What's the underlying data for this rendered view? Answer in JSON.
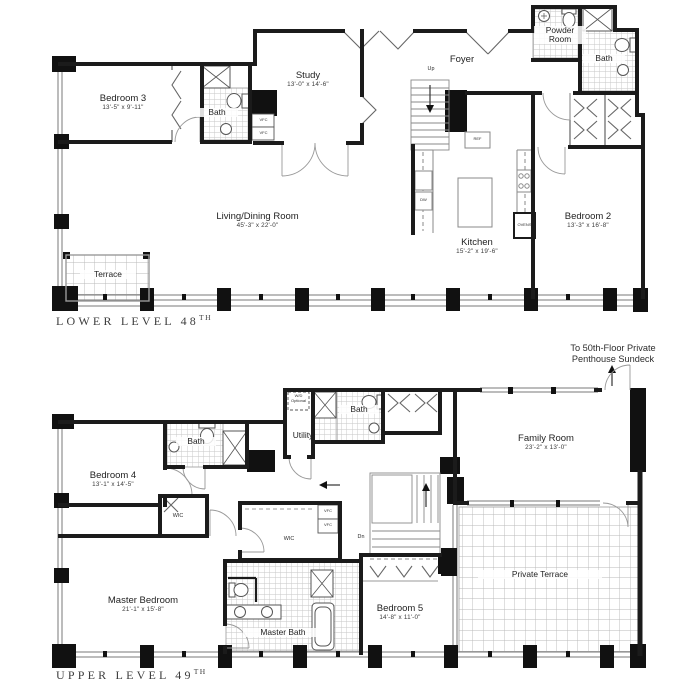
{
  "lower_level": {
    "title": "LOWER LEVEL 48",
    "title_ordinal": "TH",
    "rooms": {
      "bedroom_3": {
        "name": "Bedroom 3",
        "dims": "13'-5\" x 9'-11\""
      },
      "bath": {
        "name": "Bath"
      },
      "study": {
        "name": "Study",
        "dims": "13'-0\" x 14'-6\""
      },
      "foyer": {
        "name": "Foyer"
      },
      "powder_room": {
        "name": "Powder Room"
      },
      "bath_2": {
        "name": "Bath"
      },
      "bedroom_2": {
        "name": "Bedroom 2",
        "dims": "13'-3\" x 16'-8\""
      },
      "living_dining_room": {
        "name": "Living/Dining Room",
        "dims": "45'-3\" x 22'-0\""
      },
      "kitchen": {
        "name": "Kitchen",
        "dims": "15'-2\" x 19'-6\""
      },
      "terrace": {
        "name": "Terrace"
      }
    },
    "annotations": {
      "stair_up": "Up",
      "refrigerator": "REF",
      "dishwasher": "DW",
      "ovens": "OVENS",
      "vfc": "VFC"
    }
  },
  "upper_level": {
    "title": "UPPER LEVEL 49",
    "title_ordinal": "TH",
    "sundeck_note": {
      "line_1": "To 50th-Floor Private",
      "line_2": "Penthouse Sundeck"
    },
    "rooms": {
      "bedroom_4": {
        "name": "Bedroom 4",
        "dims": "13'-1\" x 14'-5\""
      },
      "bath": {
        "name": "Bath"
      },
      "utility": {
        "name": "Utility"
      },
      "bath_2": {
        "name": "Bath"
      },
      "family_room": {
        "name": "Family Room",
        "dims": "23'-2\" x 13'-0\""
      },
      "master_bedroom": {
        "name": "Master Bedroom",
        "dims": "21'-1\" x 15'-8\""
      },
      "master_bath": {
        "name": "Master Bath"
      },
      "bedroom_5": {
        "name": "Bedroom 5",
        "dims": "14'-8\" x 11'-0\""
      },
      "private_terrace": {
        "name": "Private Terrace"
      },
      "wic": "WIC"
    },
    "annotations": {
      "stair_dn": "Dn",
      "washer_dryer_line_1": "W/D",
      "washer_dryer_line_2": "Optional",
      "vfc": "VFC"
    }
  }
}
